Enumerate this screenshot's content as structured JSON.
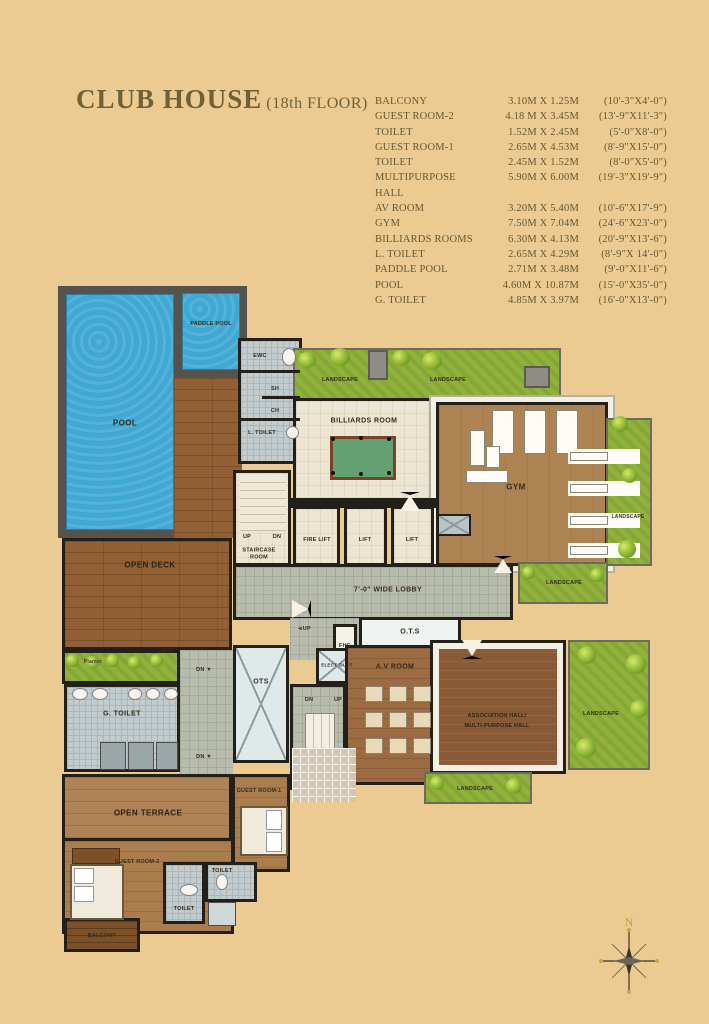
{
  "title": {
    "main": "CLUB HOUSE",
    "floor": "(18th FLOOR)"
  },
  "legend": {
    "rows": [
      {
        "name": "BALCONY",
        "metric": "3.10M X 1.25M",
        "imperial": "(10'-3\"X4'-0\")"
      },
      {
        "name": "GUEST ROOM-2",
        "metric": "4.18 M X 3.45M",
        "imperial": "(13'-9\"X11'-3\")"
      },
      {
        "name": "TOILET",
        "metric": "1.52M X 2.45M",
        "imperial": "(5'-0\"X8'-0\")"
      },
      {
        "name": "GUEST ROOM-1",
        "metric": "2.65M X 4.53M",
        "imperial": "(8'-9\"X15'-0\")"
      },
      {
        "name": "TOILET",
        "metric": "2.45M X 1.52M",
        "imperial": "(8'-0\"X5'-0\")"
      },
      {
        "name": "MULTIPURPOSE HALL",
        "metric": "5.90M X 6.00M",
        "imperial": "(19'-3\"X19'-9\")"
      },
      {
        "name": "AV ROOM",
        "metric": "3.20M X 5.40M",
        "imperial": "(10'-6\"X17'-9\")"
      },
      {
        "name": "GYM",
        "metric": "7.50M X 7.04M",
        "imperial": "(24'-6\"X23'-0\")"
      },
      {
        "name": "BILLIARDS ROOMS",
        "metric": "6.30M X 4.13M",
        "imperial": "(20'-9\"X13'-6\")"
      },
      {
        "name": "L. TOILET",
        "metric": "2.65M X 4.29M",
        "imperial": "(8'-9\"X 14'-0\")"
      },
      {
        "name": "PADDLE POOL",
        "metric": "2.71M X 3.48M",
        "imperial": "(9'-0\"X11'-6\")"
      },
      {
        "name": "POOL",
        "metric": "4.60M X 10.87M",
        "imperial": "(15'-0\"X35'-0\")"
      },
      {
        "name": "G. TOILET",
        "metric": "4.85M X 3.97M",
        "imperial": "(16'-0\"X13'-0\")"
      }
    ]
  },
  "plan": {
    "labels": {
      "pool": "POOL",
      "paddle_pool": "PADDLE POOL",
      "open_deck": "OPEN DECK",
      "ewc": "EWC",
      "sh": "SH",
      "ch": "CH",
      "l_toilet": "L. TOILET",
      "landscape": "LANDSCAPE",
      "billiards_room": "BILLIARDS ROOM",
      "gym": "GYM",
      "fire_lift": "FIRE LIFT",
      "lift": "LIFT",
      "up": "UP",
      "dn": "DN",
      "up_arrow": "◄UP",
      "dn_arrow": "DN ▼",
      "staircase_room": "STAIRCASE ROOM",
      "lobby": "7'-0\" WIDE LOBBY",
      "fhc": "FHC",
      "ots_dotted": "O.T.S",
      "elect_duct": "ELECT. DUCT",
      "av_room": "A.V ROOM",
      "association_hall_line1": "ASSOCIATION HALL/",
      "association_hall_line2": "MULTI-PURPOSE HALL",
      "ots": "OTS",
      "planter": "Planter",
      "g_toilet": "G. TOILET",
      "open_terrace": "OPEN TERRACE",
      "guest_room_1": "GUEST ROOM-1",
      "guest_room_2": "GUEST ROOM-2",
      "toilet": "TOILET",
      "balcony": "BALCONY"
    }
  },
  "compass": {
    "north": "N"
  },
  "colors": {
    "background": "#eccb93",
    "title_text": "#6f6135",
    "legend_text": "#635731",
    "pool_water": "#3fa8d3",
    "pool_frame": "#55534b",
    "grass": "#90b23b",
    "deck_wood": "#935f34",
    "gym_floor": "#ae8354",
    "hall_wood": "#8a5a36",
    "lobby_tile": "#b8bcad",
    "bath_tile": "#c2cbcd",
    "room_cream": "#ece5d2",
    "wall": "#231f19"
  }
}
